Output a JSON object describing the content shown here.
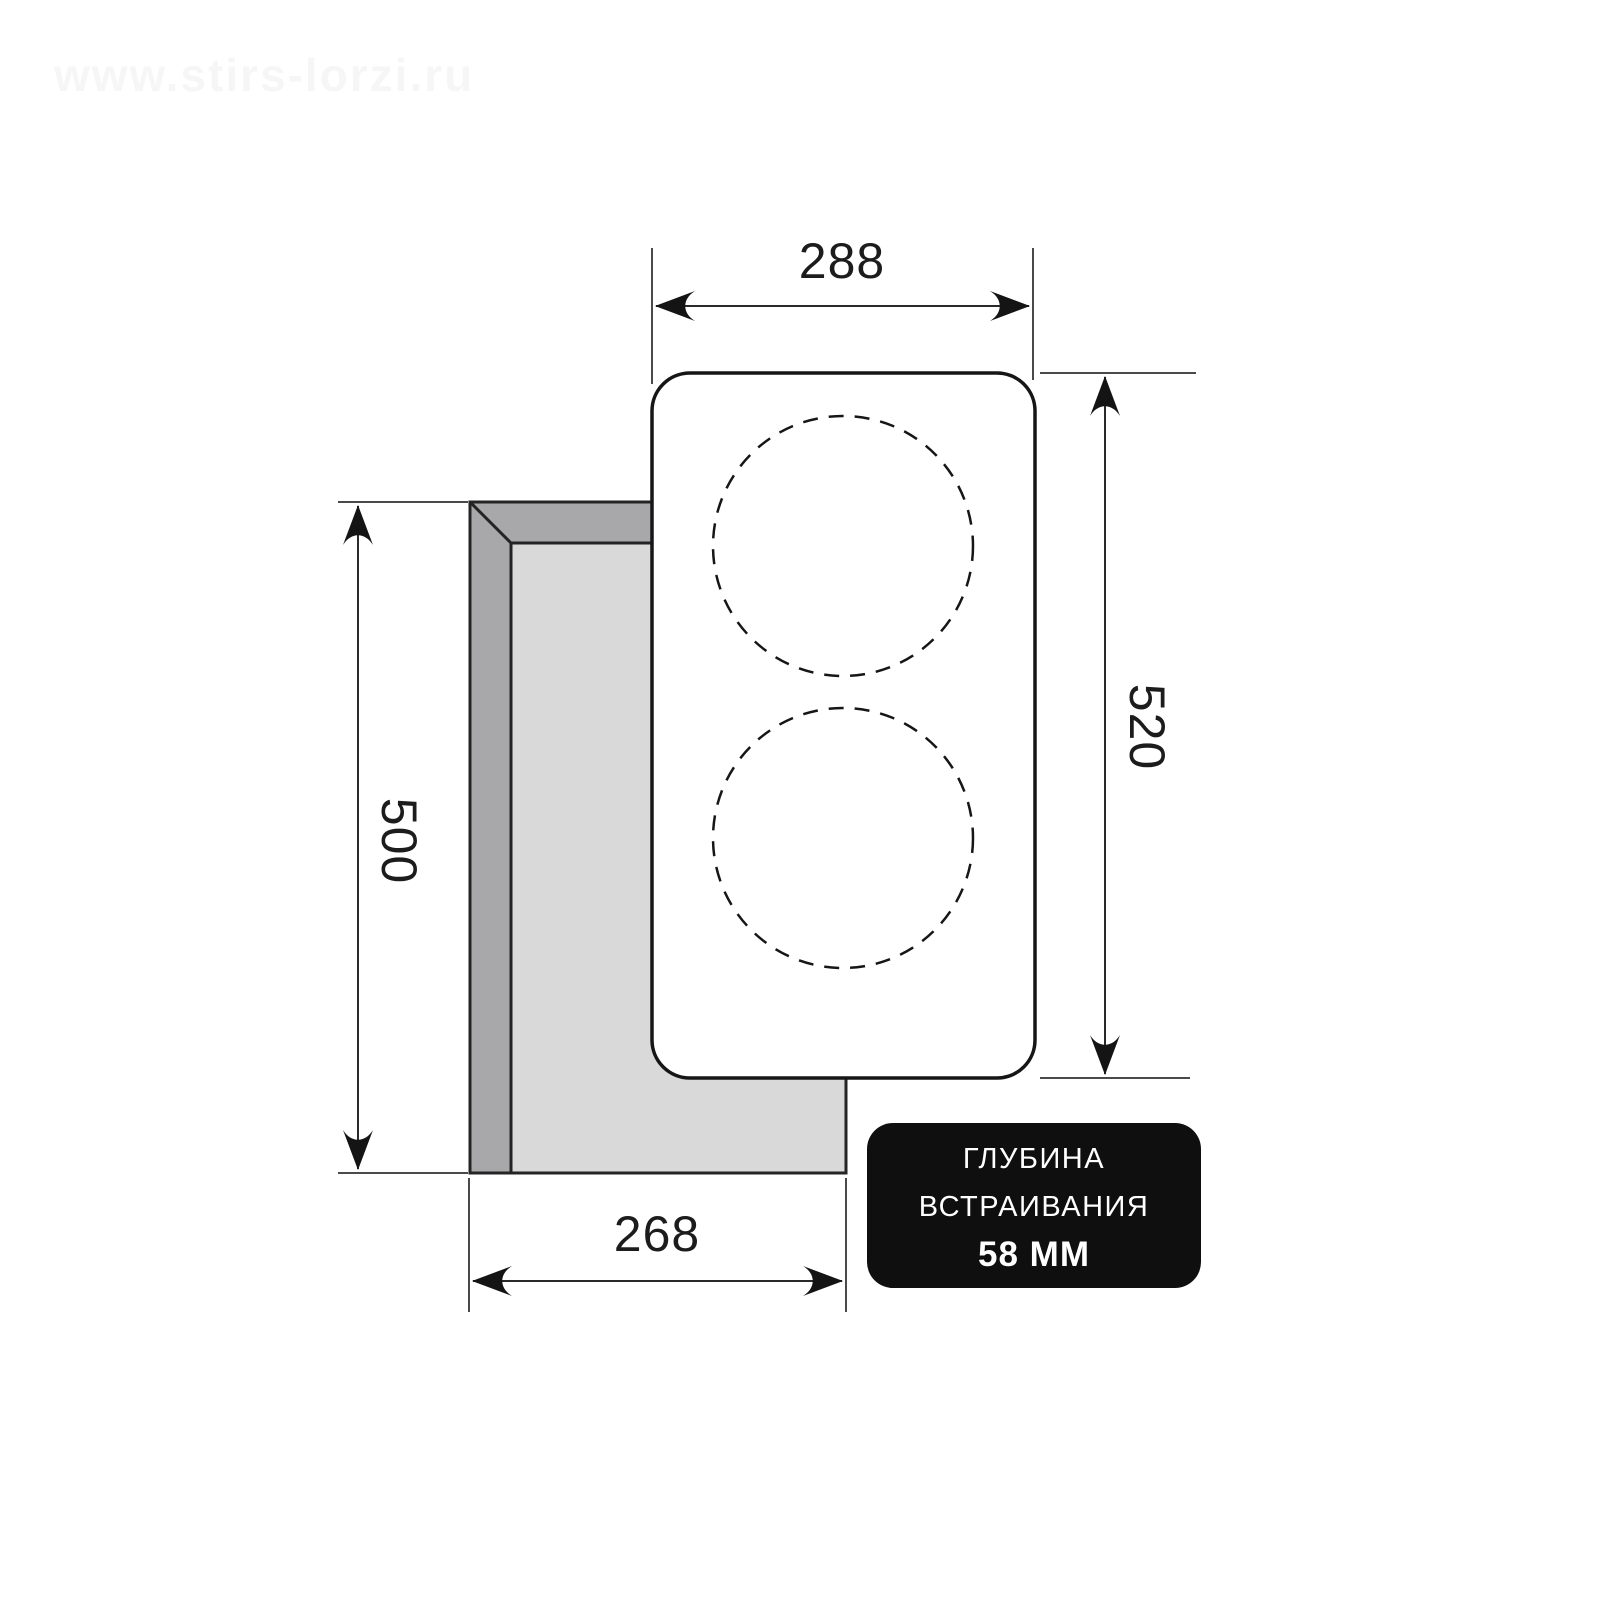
{
  "watermark": {
    "text": "www.stirs-lorzi.ru"
  },
  "diagram": {
    "type": "cooktop-installation-dimensions",
    "burner_zones": 2,
    "dimensions": {
      "panel_width_mm": "288",
      "panel_height_mm": "520",
      "cutout_height_mm": "500",
      "cutout_width_mm": "268"
    },
    "badge": {
      "line1": "ГЛУБИНА",
      "line2": "ВСТРАИВАНИЯ",
      "line3": "58 ММ"
    },
    "colors": {
      "line": "#1c1c1c",
      "cutout_wall_gray": "#a8a8aa",
      "cutout_inner_gray": "#d9d9d9",
      "badge_background": "#0f0f0f",
      "badge_text": "#ffffff"
    }
  }
}
